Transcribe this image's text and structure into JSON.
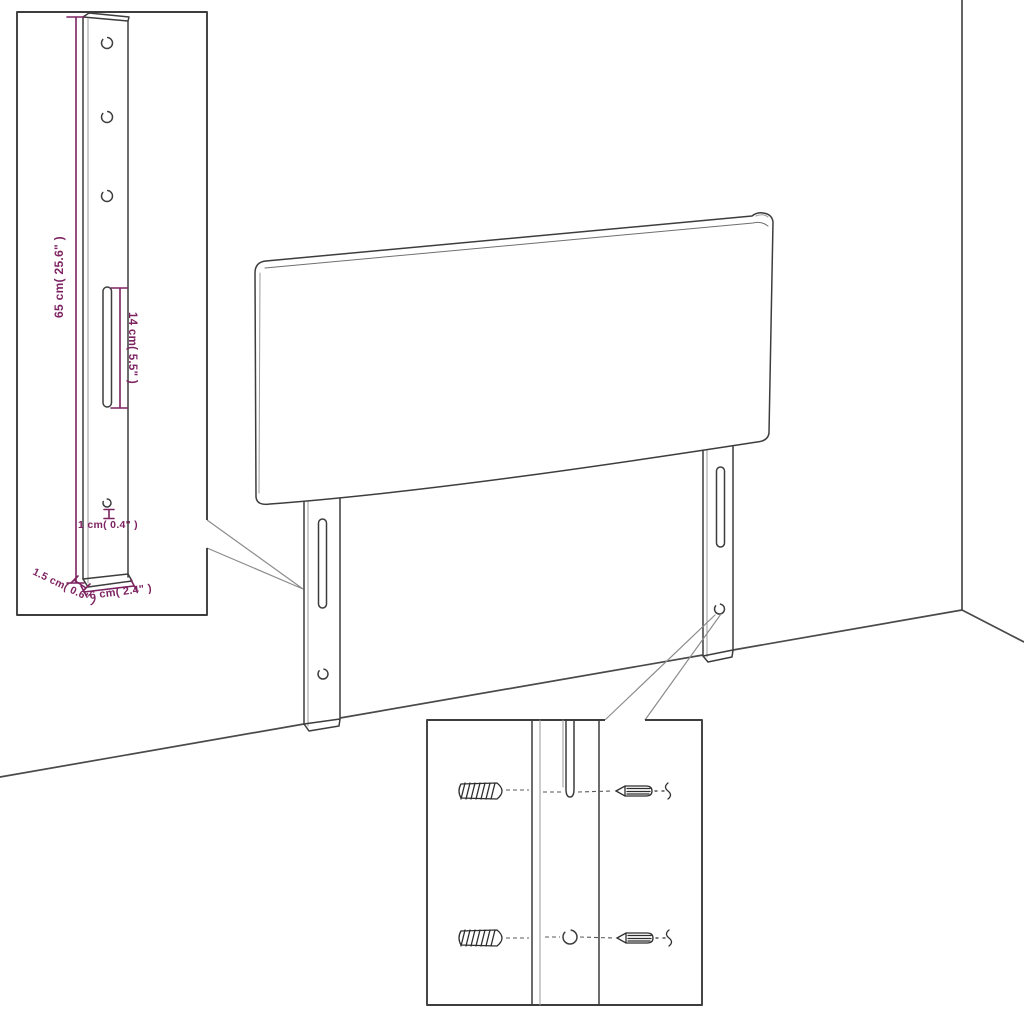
{
  "labels": {
    "leg_height": "65 cm( 25.6\" )",
    "slot_length": "14 cm( 5.5\" )",
    "hole_diameter": "1 cm( 0.4\" )",
    "leg_thickness": "1.5 cm( 0.6\" )",
    "leg_width": "6 cm( 2.4\" )"
  },
  "colors": {
    "outline": "#3d3d3d",
    "dimension_accent": "#7d2361",
    "background": "#ffffff"
  }
}
